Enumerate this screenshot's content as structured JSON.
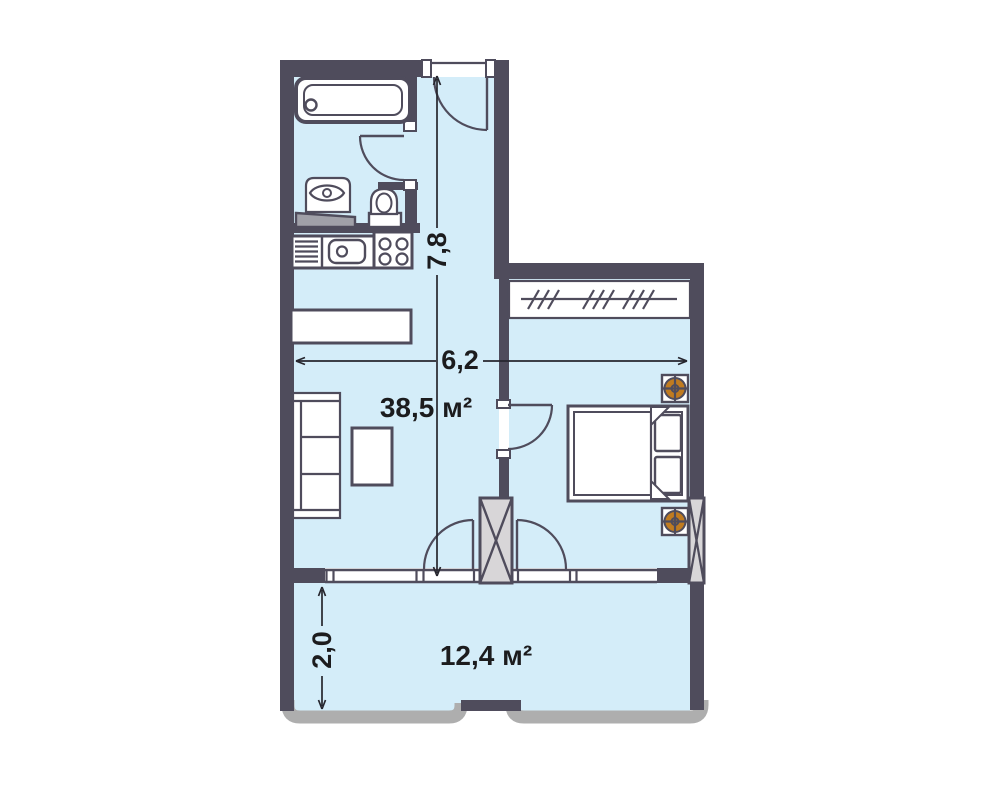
{
  "plan": {
    "areas": {
      "main_room": "38,5 м²",
      "balcony": "12,4 м²"
    },
    "dimensions": {
      "total_height_m": "7,8",
      "total_width_m": "6,2",
      "balcony_depth_m": "2,0"
    },
    "rooms": [
      "bathroom",
      "kitchen",
      "entry-hall",
      "living-room",
      "bedroom",
      "balcony"
    ],
    "furniture_icons": [
      "bathtub-icon",
      "washbasin-icon",
      "toilet-icon",
      "kitchen-grid-appliance-icon",
      "kitchen-sink-icon",
      "stove-icon",
      "bar-counter-icon",
      "sofa-icon",
      "coffee-table-icon",
      "wardrobe-icon",
      "double-bed-icon",
      "ceiling-fixture-icon",
      "ceiling-fixture-icon"
    ],
    "structure_icons": [
      "entry-door-arc",
      "bathroom-door-arc",
      "bedroom-door-arc",
      "balcony-door-arcs",
      "window-band",
      "hatched-column",
      "balcony-railing"
    ]
  },
  "colors": {
    "wall": "#4f4c5c",
    "floor": "#d4edf9",
    "railing": "#aeaeae",
    "column_fill": "#d8d6d8",
    "fixture_orange": "#c07b20",
    "text": "#1c1c1e"
  }
}
